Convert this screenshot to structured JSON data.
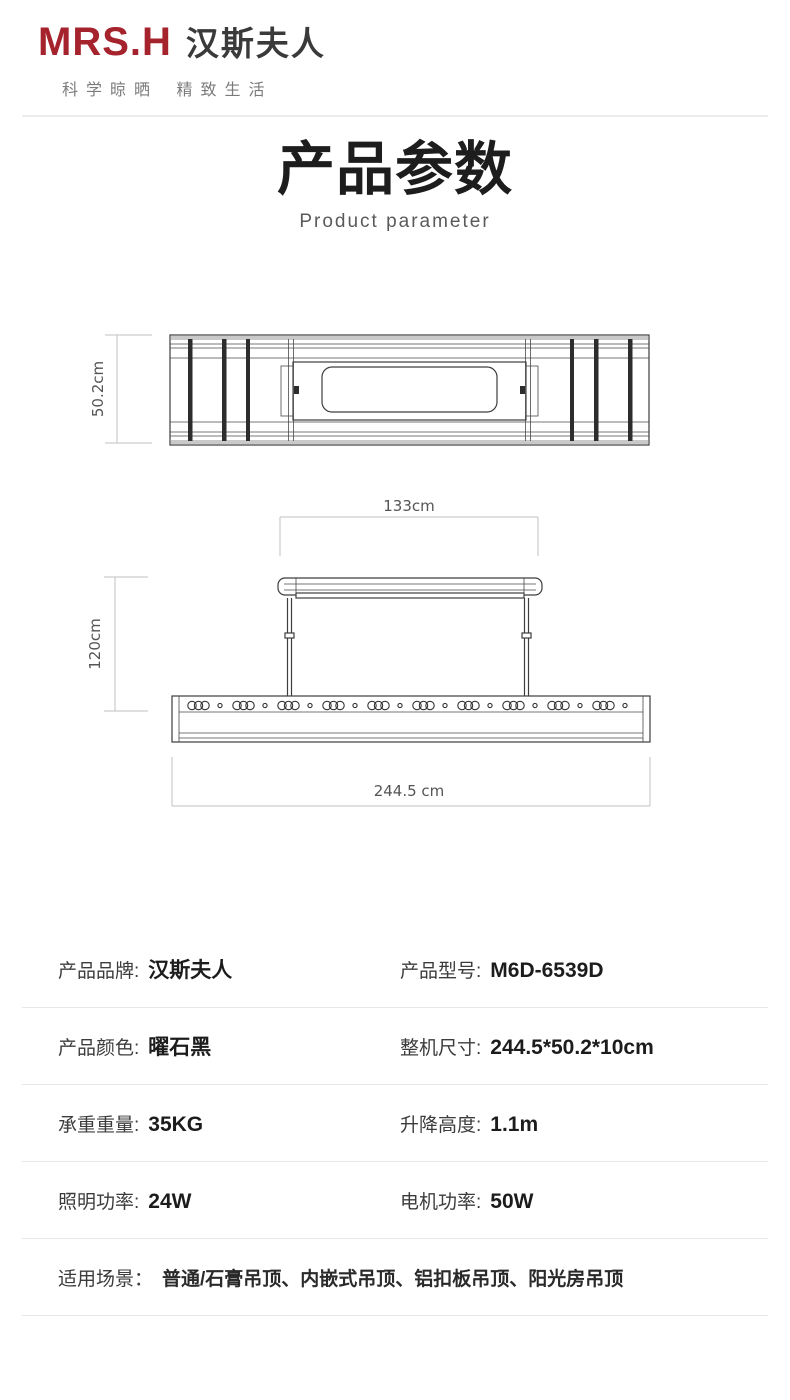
{
  "brand": {
    "logo_en": "MRS.H",
    "logo_cn": "汉斯夫人",
    "tagline": "科学晾晒 精致生活"
  },
  "header": {
    "title": "产品参数",
    "subtitle": "Product parameter"
  },
  "drawings": {
    "top_view": {
      "depth_label": "50.2cm"
    },
    "front_view": {
      "mount_width_label": "133cm",
      "drop_height_label": "120cm",
      "total_width_label": "244.5 cm"
    }
  },
  "specs": {
    "rows": [
      {
        "label": "产品品牌:",
        "value": "汉斯夫人"
      },
      {
        "label": "产品型号:",
        "value": "M6D-6539D"
      },
      {
        "label": "产品颜色:",
        "value": "曜石黑"
      },
      {
        "label": "整机尺寸:",
        "value": "244.5*50.2*10cm"
      },
      {
        "label": "承重重量:",
        "value": "35KG"
      },
      {
        "label": "升降高度:",
        "value": "1.1m"
      },
      {
        "label": "照明功率:",
        "value": "24W"
      },
      {
        "label": "电机功率:",
        "value": "50W"
      },
      {
        "label": "适用场景：",
        "value": "普通/石膏吊顶、内嵌式吊顶、铝扣板吊顶、阳光房吊顶"
      }
    ]
  },
  "colors": {
    "brand_red": "#a5232d",
    "divider": "#ececec",
    "title_dark": "#1d1d1d",
    "dim_gray": "#c2c2c2"
  }
}
